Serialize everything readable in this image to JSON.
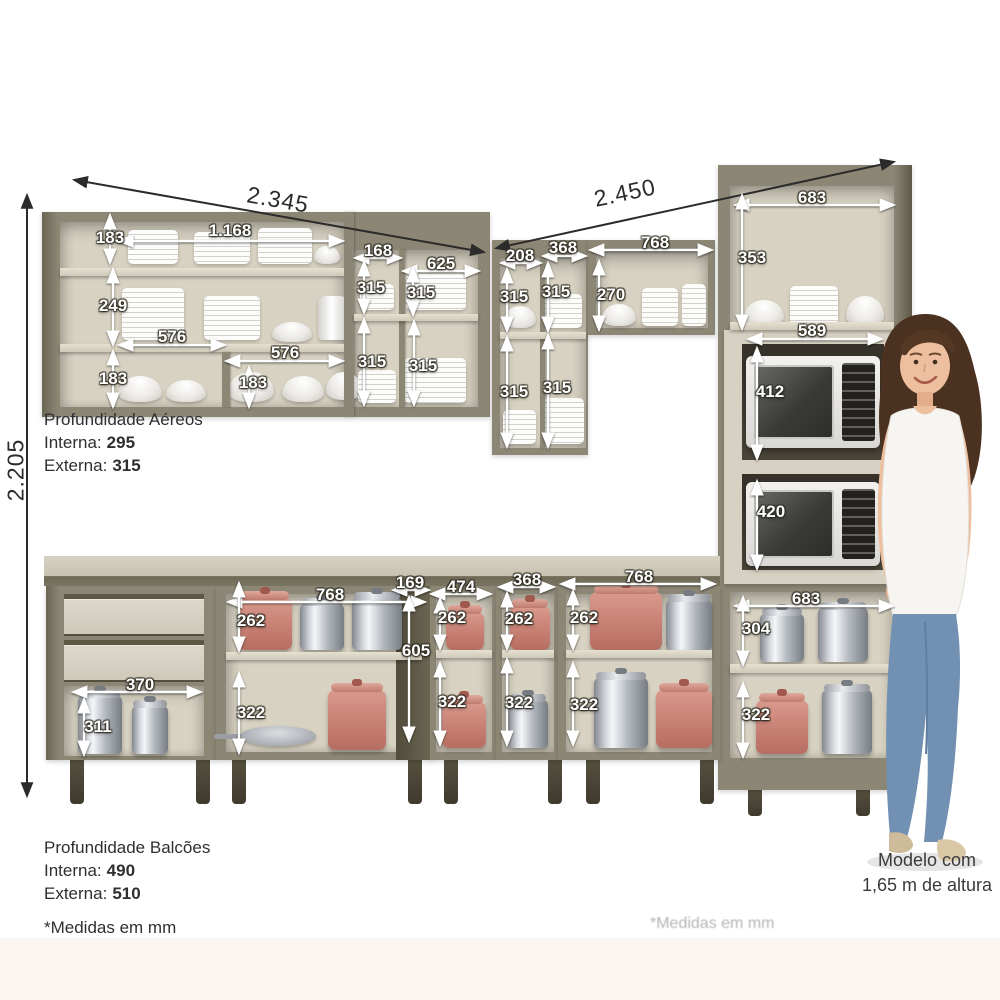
{
  "depths": {
    "aereos": {
      "title": "Profundidade Aéreos",
      "interna_label": "Interna:",
      "interna_value": "295",
      "externa_label": "Externa:",
      "externa_value": "315"
    },
    "balcoes": {
      "title": "Profundidade Balcões",
      "interna_label": "Interna:",
      "interna_value": "490",
      "externa_label": "Externa:",
      "externa_value": "510"
    }
  },
  "footnote": "*Medidas em mm",
  "watermark": "*Medidas em mm",
  "model_caption": {
    "line1": "Modelo com",
    "line2": "1,65 m de altura"
  },
  "overall_dimensions_mm": {
    "left_run_width": "2.345",
    "right_run_width": "2.450",
    "total_height": "2.205",
    "tower_width": "683"
  },
  "colors": {
    "cabinet": "#8c8675",
    "cabinet_dark": "#6b6554",
    "interior": "#d8d2c2",
    "shelf": "#ddd7c8",
    "counter": "#cdc8b8",
    "leg": "#4b4637",
    "pot_salmon": "#cb8478",
    "pot_steel": "#b4b9c0",
    "annotation_white": "#ffffff",
    "annotation_dark": "#2b2b2b",
    "jeans": "#7291b2",
    "hair": "#4a3120",
    "skin": "#edbf9e",
    "bottom_band": "#fbf5f2"
  },
  "annotations": {
    "labels": [
      {
        "t": "2.345",
        "x": 278,
        "y": 200,
        "s": "d",
        "r": 10
      },
      {
        "t": "2.450",
        "x": 625,
        "y": 193,
        "s": "d",
        "r": -12
      },
      {
        "t": "2.205",
        "x": 16,
        "y": 470,
        "s": "d",
        "r": -90
      },
      {
        "t": "183",
        "x": 110,
        "y": 238,
        "s": "w"
      },
      {
        "t": "1.168",
        "x": 230,
        "y": 231,
        "s": "w"
      },
      {
        "t": "249",
        "x": 113,
        "y": 306,
        "s": "w"
      },
      {
        "t": "576",
        "x": 172,
        "y": 337,
        "s": "w"
      },
      {
        "t": "183",
        "x": 113,
        "y": 379,
        "s": "w"
      },
      {
        "t": "576",
        "x": 285,
        "y": 353,
        "s": "w"
      },
      {
        "t": "183",
        "x": 253,
        "y": 383,
        "s": "w"
      },
      {
        "t": "168",
        "x": 378,
        "y": 251,
        "s": "w"
      },
      {
        "t": "625",
        "x": 441,
        "y": 264,
        "s": "w"
      },
      {
        "t": "315",
        "x": 371,
        "y": 288,
        "s": "w"
      },
      {
        "t": "315",
        "x": 421,
        "y": 293,
        "s": "w"
      },
      {
        "t": "315",
        "x": 372,
        "y": 362,
        "s": "w"
      },
      {
        "t": "315",
        "x": 423,
        "y": 366,
        "s": "w"
      },
      {
        "t": "208",
        "x": 520,
        "y": 256,
        "s": "w"
      },
      {
        "t": "368",
        "x": 563,
        "y": 248,
        "s": "w"
      },
      {
        "t": "315",
        "x": 514,
        "y": 297,
        "s": "w"
      },
      {
        "t": "315",
        "x": 556,
        "y": 292,
        "s": "w"
      },
      {
        "t": "315",
        "x": 514,
        "y": 392,
        "s": "w"
      },
      {
        "t": "315",
        "x": 557,
        "y": 388,
        "s": "w"
      },
      {
        "t": "768",
        "x": 655,
        "y": 243,
        "s": "w"
      },
      {
        "t": "270",
        "x": 611,
        "y": 295,
        "s": "w"
      },
      {
        "t": "683",
        "x": 812,
        "y": 198,
        "s": "w"
      },
      {
        "t": "353",
        "x": 752,
        "y": 258,
        "s": "w"
      },
      {
        "t": "589",
        "x": 812,
        "y": 331,
        "s": "w"
      },
      {
        "t": "412",
        "x": 770,
        "y": 392,
        "s": "w"
      },
      {
        "t": "420",
        "x": 771,
        "y": 512,
        "s": "w"
      },
      {
        "t": "683",
        "x": 806,
        "y": 599,
        "s": "w"
      },
      {
        "t": "304",
        "x": 756,
        "y": 629,
        "s": "w"
      },
      {
        "t": "322",
        "x": 756,
        "y": 715,
        "s": "w"
      },
      {
        "t": "370",
        "x": 140,
        "y": 685,
        "s": "w"
      },
      {
        "t": "311",
        "x": 98,
        "y": 727,
        "s": "w"
      },
      {
        "t": "768",
        "x": 330,
        "y": 595,
        "s": "w"
      },
      {
        "t": "262",
        "x": 251,
        "y": 621,
        "s": "w"
      },
      {
        "t": "322",
        "x": 251,
        "y": 713,
        "s": "w"
      },
      {
        "t": "169",
        "x": 410,
        "y": 583,
        "s": "w"
      },
      {
        "t": "605",
        "x": 416,
        "y": 651,
        "s": "w"
      },
      {
        "t": "474",
        "x": 461,
        "y": 587,
        "s": "w"
      },
      {
        "t": "262",
        "x": 452,
        "y": 618,
        "s": "w"
      },
      {
        "t": "322",
        "x": 452,
        "y": 702,
        "s": "w"
      },
      {
        "t": "368",
        "x": 527,
        "y": 580,
        "s": "w"
      },
      {
        "t": "262",
        "x": 519,
        "y": 619,
        "s": "w"
      },
      {
        "t": "322",
        "x": 519,
        "y": 703,
        "s": "w"
      },
      {
        "t": "768",
        "x": 639,
        "y": 577,
        "s": "w"
      },
      {
        "t": "262",
        "x": 584,
        "y": 618,
        "s": "w"
      },
      {
        "t": "322",
        "x": 584,
        "y": 705,
        "s": "w"
      }
    ],
    "arrows": [
      [
        75,
        180,
        483,
        252,
        "d"
      ],
      [
        497,
        248,
        893,
        162,
        "d"
      ],
      [
        27,
        196,
        27,
        795,
        "d"
      ],
      [
        110,
        216,
        110,
        262,
        "w"
      ],
      [
        120,
        241,
        342,
        241,
        "w"
      ],
      [
        113,
        270,
        113,
        344,
        "w"
      ],
      [
        120,
        345,
        224,
        345,
        "w"
      ],
      [
        113,
        352,
        113,
        406,
        "w"
      ],
      [
        227,
        361,
        342,
        361,
        "w"
      ],
      [
        249,
        368,
        249,
        406,
        "w"
      ],
      [
        356,
        258,
        400,
        258,
        "w"
      ],
      [
        404,
        271,
        478,
        271,
        "w"
      ],
      [
        364,
        263,
        364,
        312,
        "w"
      ],
      [
        413,
        269,
        413,
        314,
        "w"
      ],
      [
        364,
        320,
        364,
        404,
        "w"
      ],
      [
        414,
        322,
        414,
        404,
        "w"
      ],
      [
        502,
        263,
        540,
        263,
        "w"
      ],
      [
        544,
        256,
        585,
        256,
        "w"
      ],
      [
        507,
        270,
        507,
        330,
        "w"
      ],
      [
        548,
        264,
        548,
        330,
        "w"
      ],
      [
        507,
        338,
        507,
        446,
        "w"
      ],
      [
        548,
        336,
        548,
        446,
        "w"
      ],
      [
        591,
        250,
        711,
        250,
        "w"
      ],
      [
        599,
        262,
        599,
        329,
        "w"
      ],
      [
        736,
        205,
        893,
        205,
        "w"
      ],
      [
        742,
        196,
        742,
        328,
        "w"
      ],
      [
        749,
        339,
        881,
        339,
        "w"
      ],
      [
        757,
        349,
        757,
        458,
        "w"
      ],
      [
        757,
        482,
        757,
        568,
        "w"
      ],
      [
        736,
        606,
        892,
        606,
        "w"
      ],
      [
        743,
        598,
        743,
        664,
        "w"
      ],
      [
        743,
        684,
        743,
        756,
        "w"
      ],
      [
        74,
        692,
        200,
        692,
        "w"
      ],
      [
        84,
        700,
        84,
        754,
        "w"
      ],
      [
        229,
        602,
        424,
        602,
        "w"
      ],
      [
        239,
        584,
        239,
        650,
        "w"
      ],
      [
        239,
        674,
        239,
        752,
        "w"
      ],
      [
        394,
        590,
        428,
        590,
        "w"
      ],
      [
        409,
        598,
        409,
        740,
        "w"
      ],
      [
        432,
        594,
        490,
        594,
        "w"
      ],
      [
        440,
        600,
        440,
        648,
        "w"
      ],
      [
        440,
        664,
        440,
        744,
        "w"
      ],
      [
        500,
        587,
        553,
        587,
        "w"
      ],
      [
        507,
        594,
        507,
        648,
        "w"
      ],
      [
        507,
        660,
        507,
        744,
        "w"
      ],
      [
        562,
        584,
        714,
        584,
        "w"
      ],
      [
        573,
        592,
        573,
        648,
        "w"
      ],
      [
        573,
        664,
        573,
        744,
        "w"
      ]
    ]
  },
  "props": [
    {
      "type": "plates",
      "x": 128,
      "y": 230,
      "w": 50,
      "h": 34
    },
    {
      "type": "plates",
      "x": 194,
      "y": 232,
      "w": 56,
      "h": 32
    },
    {
      "type": "plates",
      "x": 258,
      "y": 228,
      "w": 54,
      "h": 36
    },
    {
      "type": "bowl",
      "x": 314,
      "y": 246,
      "w": 26,
      "h": 18
    },
    {
      "type": "plates",
      "x": 122,
      "y": 288,
      "w": 62,
      "h": 52
    },
    {
      "type": "plates",
      "x": 204,
      "y": 296,
      "w": 56,
      "h": 44
    },
    {
      "type": "bowl",
      "x": 272,
      "y": 322,
      "w": 40,
      "h": 20
    },
    {
      "type": "canister",
      "x": 318,
      "y": 296,
      "w": 30,
      "h": 44
    },
    {
      "type": "bowl",
      "x": 118,
      "y": 376,
      "w": 44,
      "h": 26
    },
    {
      "type": "bowl",
      "x": 166,
      "y": 380,
      "w": 40,
      "h": 22
    },
    {
      "type": "bowl",
      "x": 228,
      "y": 372,
      "w": 46,
      "h": 30
    },
    {
      "type": "bowl",
      "x": 282,
      "y": 376,
      "w": 42,
      "h": 26
    },
    {
      "type": "bowl",
      "x": 326,
      "y": 372,
      "w": 36,
      "h": 28
    },
    {
      "type": "plates",
      "x": 360,
      "y": 284,
      "w": 34,
      "h": 26
    },
    {
      "type": "plates",
      "x": 406,
      "y": 274,
      "w": 60,
      "h": 36
    },
    {
      "type": "plates",
      "x": 358,
      "y": 370,
      "w": 38,
      "h": 33
    },
    {
      "type": "plates",
      "x": 404,
      "y": 358,
      "w": 62,
      "h": 45
    },
    {
      "type": "bowl",
      "x": 504,
      "y": 306,
      "w": 32,
      "h": 22
    },
    {
      "type": "plates",
      "x": 545,
      "y": 294,
      "w": 37,
      "h": 34
    },
    {
      "type": "plates",
      "x": 503,
      "y": 410,
      "w": 33,
      "h": 34
    },
    {
      "type": "plates",
      "x": 544,
      "y": 398,
      "w": 40,
      "h": 46
    },
    {
      "type": "bowl",
      "x": 602,
      "y": 304,
      "w": 34,
      "h": 22
    },
    {
      "type": "plates",
      "x": 642,
      "y": 288,
      "w": 36,
      "h": 38
    },
    {
      "type": "plates",
      "x": 682,
      "y": 284,
      "w": 24,
      "h": 42
    },
    {
      "type": "bowl",
      "x": 744,
      "y": 300,
      "w": 40,
      "h": 26
    },
    {
      "type": "plates",
      "x": 790,
      "y": 286,
      "w": 48,
      "h": 40
    },
    {
      "type": "bowl",
      "x": 846,
      "y": 296,
      "w": 38,
      "h": 30
    },
    {
      "type": "pot-steel",
      "x": 760,
      "y": 614,
      "w": 44,
      "h": 48
    },
    {
      "type": "pot-steel",
      "x": 818,
      "y": 608,
      "w": 50,
      "h": 54
    },
    {
      "type": "pot-salmon",
      "x": 756,
      "y": 700,
      "w": 52,
      "h": 54
    },
    {
      "type": "pot-steel",
      "x": 822,
      "y": 690,
      "w": 50,
      "h": 64
    },
    {
      "type": "pot-steel",
      "x": 78,
      "y": 696,
      "w": 44,
      "h": 58
    },
    {
      "type": "pot-steel",
      "x": 132,
      "y": 706,
      "w": 36,
      "h": 48
    },
    {
      "type": "pot-salmon",
      "x": 238,
      "y": 598,
      "w": 54,
      "h": 52
    },
    {
      "type": "pot-steel",
      "x": 300,
      "y": 604,
      "w": 44,
      "h": 46
    },
    {
      "type": "pot-steel",
      "x": 352,
      "y": 598,
      "w": 50,
      "h": 52
    },
    {
      "type": "pan",
      "x": 240,
      "y": 726,
      "w": 76,
      "h": 20
    },
    {
      "type": "pot-salmon",
      "x": 328,
      "y": 690,
      "w": 58,
      "h": 60
    },
    {
      "type": "pot-salmon",
      "x": 446,
      "y": 612,
      "w": 38,
      "h": 38
    },
    {
      "type": "pot-salmon",
      "x": 442,
      "y": 702,
      "w": 44,
      "h": 46
    },
    {
      "type": "pot-salmon",
      "x": 510,
      "y": 606,
      "w": 40,
      "h": 44
    },
    {
      "type": "pot-steel",
      "x": 508,
      "y": 700,
      "w": 40,
      "h": 48
    },
    {
      "type": "pot-salmon",
      "x": 590,
      "y": 592,
      "w": 72,
      "h": 58
    },
    {
      "type": "pot-steel",
      "x": 666,
      "y": 600,
      "w": 46,
      "h": 50
    },
    {
      "type": "pot-steel",
      "x": 594,
      "y": 678,
      "w": 54,
      "h": 70
    },
    {
      "type": "pot-salmon",
      "x": 656,
      "y": 690,
      "w": 56,
      "h": 58
    }
  ]
}
